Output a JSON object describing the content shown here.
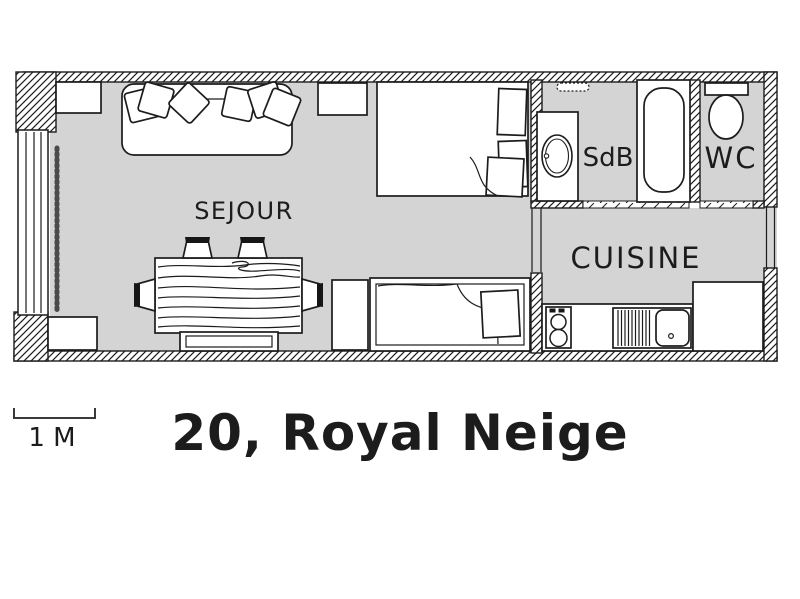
{
  "title": "20, Royal Neige",
  "scale_bar": {
    "label": "1 M"
  },
  "rooms": {
    "sejour": {
      "label": "SEJOUR"
    },
    "sdb": {
      "label": "SdB"
    },
    "wc": {
      "label": "WC"
    },
    "cuisine": {
      "label": "CUISINE"
    }
  },
  "colors": {
    "background": "#ffffff",
    "floor": "#d4d4d4",
    "line": "#1c1c1c"
  },
  "icons": [
    "sofa-icon",
    "cushion-icon",
    "double-bed-icon",
    "pillow-icon",
    "single-bed-icon",
    "dining-table-icon",
    "chair-icon",
    "bench-icon",
    "closet-icon",
    "side-table-icon",
    "nightstand-icon",
    "cabinet-icon",
    "window-icon",
    "curtain-icon",
    "washbasin-icon",
    "bathtub-icon",
    "toilet-icon",
    "vent-icon",
    "stove-icon",
    "drainer-icon",
    "kitchen-sink-icon",
    "counter-icon",
    "fridge-icon",
    "door-opening-icon",
    "scale-bar-icon"
  ]
}
